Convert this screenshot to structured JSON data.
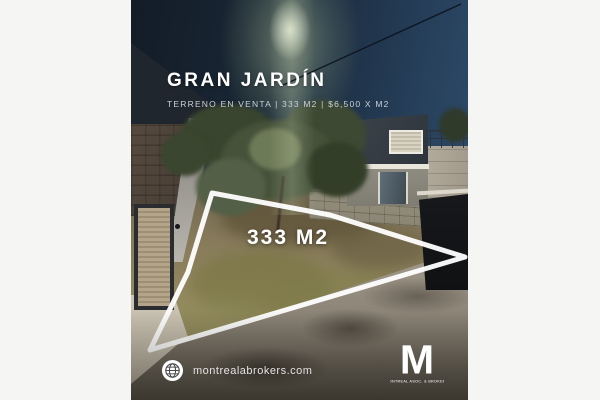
{
  "flyer": {
    "title": "GRAN JARDÍN",
    "subtitle": "TERRENO EN VENTA  |  333 M2  |  $6,500 X M2",
    "area_label": "333 M2",
    "website": "montrealabrokers.com",
    "logo": {
      "letter_mark": "M",
      "tagline": "MONTREAL ASOC. & BROKERS"
    },
    "icons": {
      "website_icon": "globe-icon"
    },
    "colors": {
      "canvas_margin": "#f5f5f4",
      "overlay_text": "#ffffff",
      "subtitle_text": "#c9d1d8",
      "lot_outline": "#ffffff"
    }
  }
}
